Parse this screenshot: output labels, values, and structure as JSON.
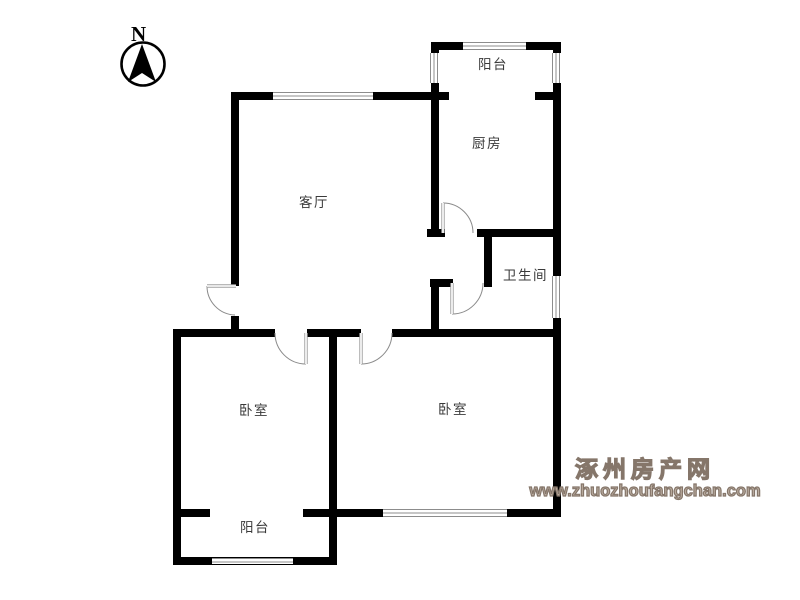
{
  "compass": {
    "label": "N"
  },
  "rooms": [
    {
      "id": "balcony-top",
      "label": "阳台"
    },
    {
      "id": "kitchen",
      "label": "厨房"
    },
    {
      "id": "living-room",
      "label": "客厅"
    },
    {
      "id": "bathroom",
      "label": "卫生间"
    },
    {
      "id": "bedroom-left",
      "label": "卧室"
    },
    {
      "id": "bedroom-right",
      "label": "卧室"
    },
    {
      "id": "balcony-bottom",
      "label": "阳台"
    }
  ],
  "watermark": {
    "site_name": "涿州房产网",
    "site_url": "www.zhuozhoufangchan.com"
  },
  "colors": {
    "wall": "#000000",
    "window_line": "#8c8c8c",
    "door": "#a0a0a0",
    "label_text": "#3a3a3a",
    "watermark": "#85766a"
  }
}
